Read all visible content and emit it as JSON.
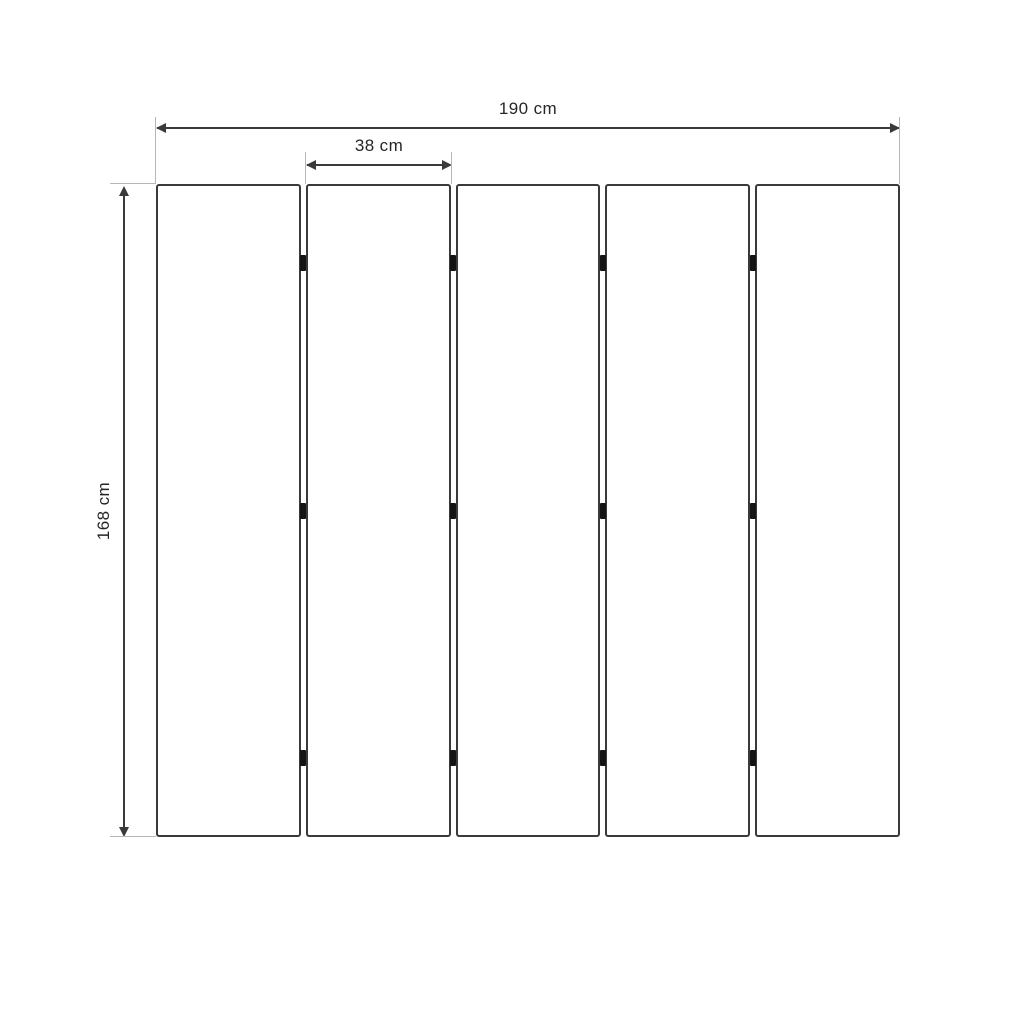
{
  "diagram": {
    "type": "dimensioned-technical-drawing",
    "subject": "five-panel folding screen room divider, front elevation",
    "panel_count": 5,
    "hinge_rows": 3,
    "hinge_marks_total": 12,
    "dimensions": {
      "total_width_label": "190 cm",
      "total_width_value": 190,
      "panel_width_label": "38 cm",
      "panel_width_value": 38,
      "height_label": "168 cm",
      "height_value": 168,
      "unit": "cm"
    },
    "colors": {
      "background": "#ffffff",
      "panel_stroke": "#3a3a3a",
      "panel_fill": "#ffffff",
      "dimension_line": "#3a3a3a",
      "extension_line": "#b6b6b6",
      "hinge": "#141414",
      "text": "#262626"
    }
  }
}
